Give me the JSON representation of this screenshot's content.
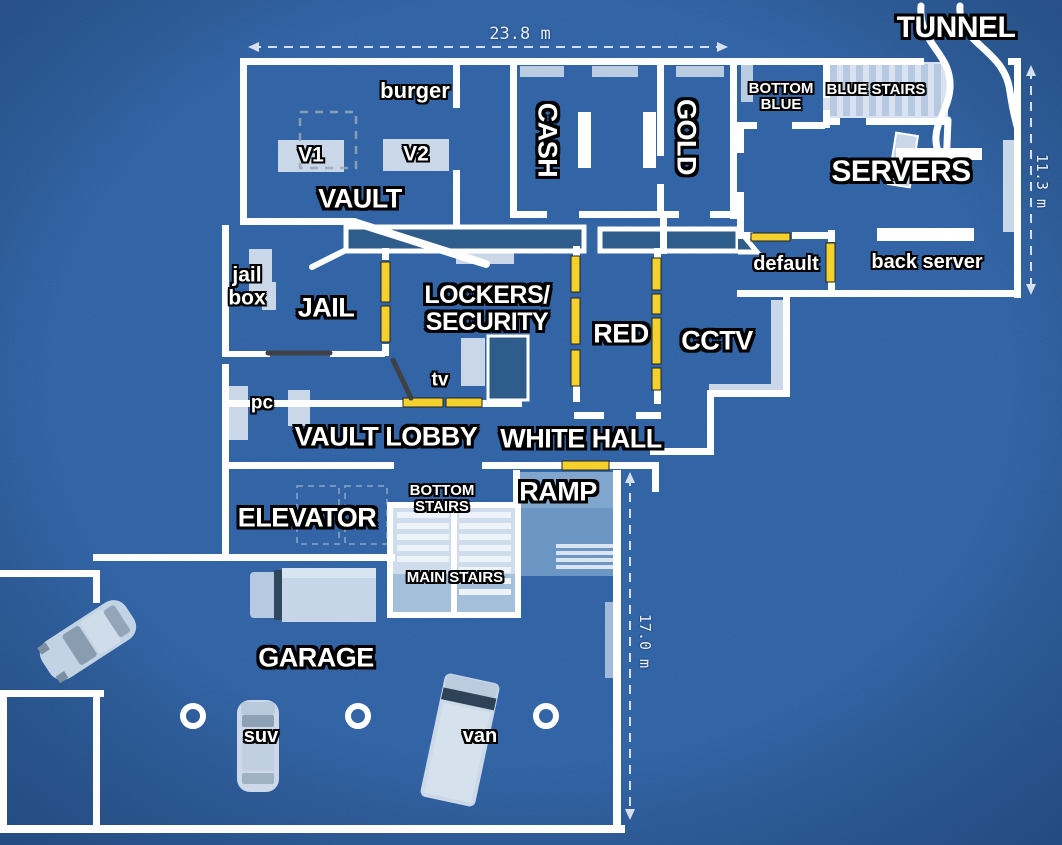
{
  "colors": {
    "background": "#2b5fa3",
    "walls": "#ffffff",
    "floor_accent": "#c9d7e9",
    "counter": "#2f5d8b",
    "breach_marker": "#f5d22b",
    "stair_tread": "#b7c9e1",
    "door_gray": "#3f4147",
    "label_text": "#ffffff",
    "label_outline": "#000000"
  },
  "labels": {
    "tunnel": "TUNNEL",
    "dim_width_top": "23.8 m",
    "burger": "burger",
    "bottom_blue": "BOTTOM\nBLUE",
    "blue_stairs": "BLUE STAIRS",
    "cash": "CASH",
    "gold": "GOLD",
    "servers": "SERVERS",
    "dim_height_right": "11.3 m",
    "v1": "V1",
    "v2": "V2",
    "vault": "VAULT",
    "jail_box": "jail\nbox",
    "jail": "JAIL",
    "lockers_security": "LOCKERS/\nSECURITY",
    "red": "RED",
    "default_wall": "default",
    "back_server": "back server",
    "cctv": "CCTV",
    "tv": "tv",
    "pc": "pc",
    "vault_lobby": "VAULT LOBBY",
    "white_hall": "WHITE HALL",
    "elevator": "ELEVATOR",
    "bottom_stairs": "BOTTOM\nSTAIRS",
    "ramp": "RAMP",
    "main_stairs": "MAIN STAIRS",
    "garage": "GARAGE",
    "suv": "suv",
    "van": "van",
    "dim_height_garage": "17.0 m"
  },
  "objects": {
    "vehicles": [
      {
        "name": "truck"
      },
      {
        "name": "sedan"
      },
      {
        "name": "suv"
      },
      {
        "name": "van"
      }
    ],
    "garage_pillar_count": 3,
    "vault_tables": [
      "V1",
      "V2"
    ],
    "breachable_wall_segments": 14
  }
}
